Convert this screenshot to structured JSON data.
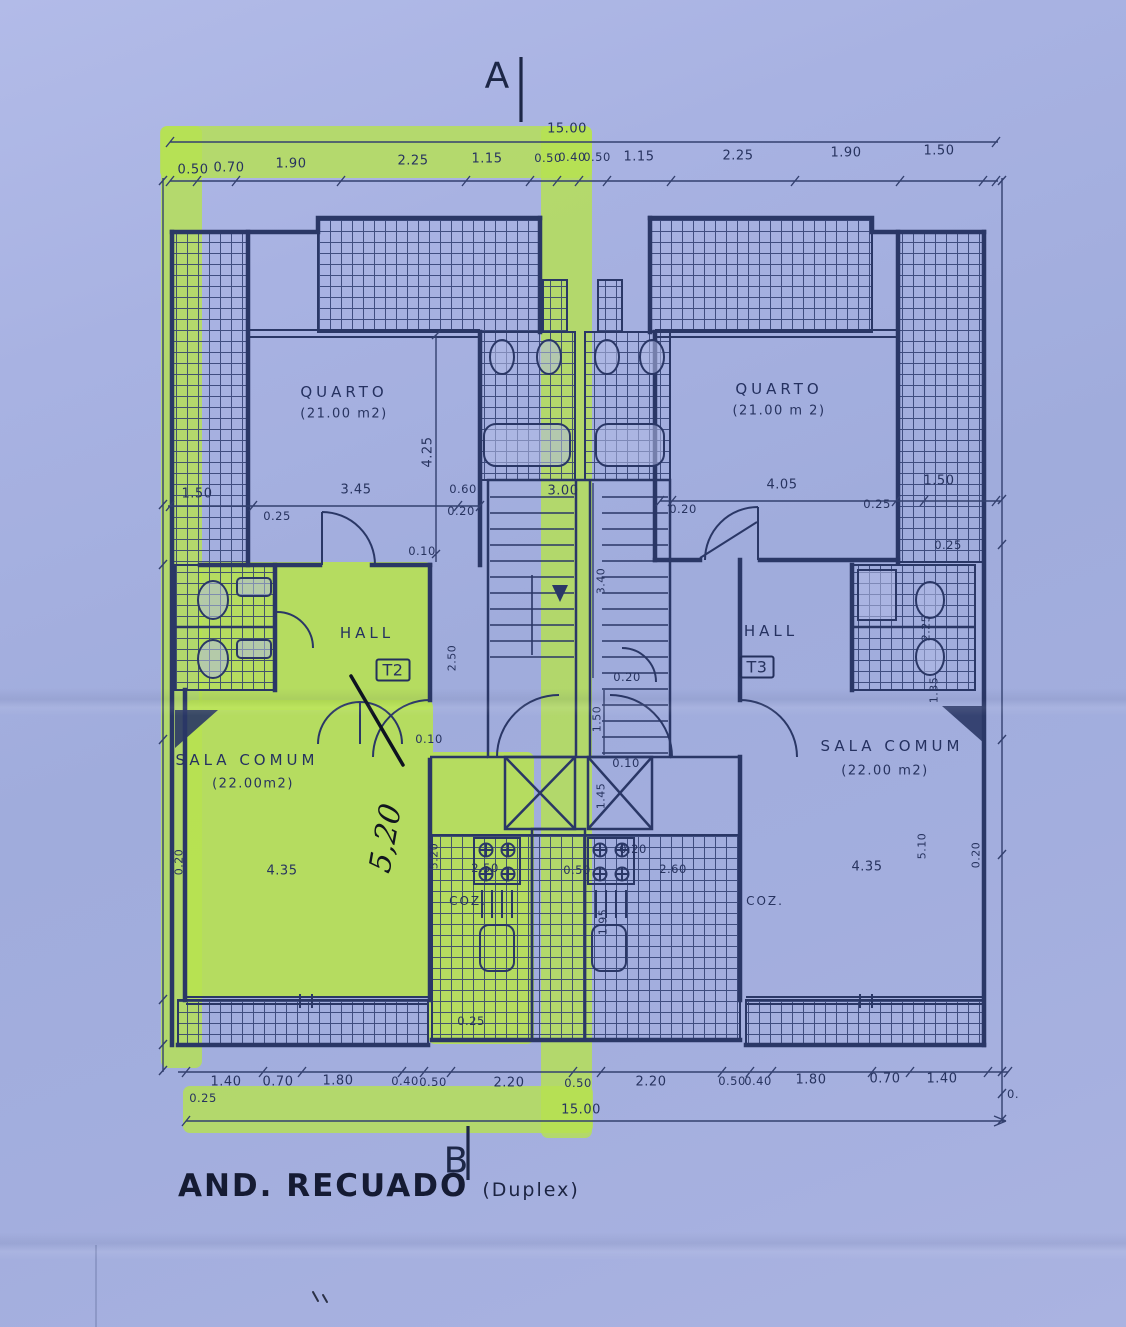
{
  "page": {
    "paper_color": "#a6b1e0",
    "ink_color": "#2a3766",
    "highlight_color": "#b7e24f"
  },
  "title": {
    "main": "AND. RECUADO",
    "sub": "(Duplex)"
  },
  "section_markers": {
    "top": "A",
    "bottom": "B"
  },
  "plan": {
    "overall_width_top": "15.00",
    "overall_width_bottom": "15.00",
    "units": [
      "T2",
      "T3"
    ],
    "rooms": [
      {
        "name": "QUARTO",
        "area": "(21.00 m2)",
        "unit": "T2"
      },
      {
        "name": "QUARTO",
        "area": "(21.00 m 2)",
        "unit": "T3"
      },
      {
        "name": "HALL",
        "unit": "T2"
      },
      {
        "name": "HALL",
        "unit": "T3"
      },
      {
        "name": "SALA COMUM",
        "area": "(22.00m2)",
        "unit": "T2"
      },
      {
        "name": "SALA COMUM",
        "area": "(22.00 m2)",
        "unit": "T3"
      },
      {
        "name": "COZ.",
        "unit": "T2"
      },
      {
        "name": "COZ.",
        "unit": "T3"
      }
    ]
  },
  "labels": [
    {
      "n": "dim-label",
      "t": "15.00",
      "x": 567,
      "y": 129,
      "c": "d"
    },
    {
      "n": "dim-label",
      "t": "0.50",
      "x": 193,
      "y": 170,
      "c": "d"
    },
    {
      "n": "dim-label",
      "t": "0.70",
      "x": 229,
      "y": 168,
      "c": "d"
    },
    {
      "n": "dim-label",
      "t": "1.90",
      "x": 291,
      "y": 164,
      "c": "d"
    },
    {
      "n": "dim-label",
      "t": "2.25",
      "x": 413,
      "y": 161,
      "c": "d"
    },
    {
      "n": "dim-label",
      "t": "1.15",
      "x": 487,
      "y": 159,
      "c": "d"
    },
    {
      "n": "dim-label",
      "t": "0.50",
      "x": 548,
      "y": 158,
      "c": "ds"
    },
    {
      "n": "dim-label",
      "t": "0.40",
      "x": 572,
      "y": 157,
      "c": "ds"
    },
    {
      "n": "dim-label",
      "t": "0.50",
      "x": 597,
      "y": 157,
      "c": "ds"
    },
    {
      "n": "dim-label",
      "t": "1.15",
      "x": 639,
      "y": 157,
      "c": "d"
    },
    {
      "n": "dim-label",
      "t": "2.25",
      "x": 738,
      "y": 156,
      "c": "d"
    },
    {
      "n": "dim-label",
      "t": "1.90",
      "x": 846,
      "y": 153,
      "c": "d"
    },
    {
      "n": "dim-label",
      "t": "1.50",
      "x": 939,
      "y": 151,
      "c": "d"
    },
    {
      "n": "room-label",
      "t": "QUARTO",
      "x": 344,
      "y": 392,
      "c": "room"
    },
    {
      "n": "area-label",
      "t": "(21.00 m2)",
      "x": 344,
      "y": 414,
      "c": "area"
    },
    {
      "n": "room-label",
      "t": "QUARTO",
      "x": 779,
      "y": 389,
      "c": "room"
    },
    {
      "n": "area-label",
      "t": "(21.00 m 2)",
      "x": 779,
      "y": 411,
      "c": "area"
    },
    {
      "n": "dim-label",
      "t": "4.25",
      "x": 428,
      "y": 452,
      "c": "dv"
    },
    {
      "n": "dim-label",
      "t": "1.50",
      "x": 197,
      "y": 494,
      "c": "d"
    },
    {
      "n": "dim-label",
      "t": "3.45",
      "x": 356,
      "y": 490,
      "c": "d"
    },
    {
      "n": "dim-label",
      "t": "0.25",
      "x": 277,
      "y": 516,
      "c": "ds"
    },
    {
      "n": "dim-label",
      "t": "0.60",
      "x": 463,
      "y": 489,
      "c": "ds"
    },
    {
      "n": "dim-label",
      "t": "0.20",
      "x": 461,
      "y": 511,
      "c": "ds"
    },
    {
      "n": "dim-label",
      "t": "3.00",
      "x": 563,
      "y": 491,
      "c": "d"
    },
    {
      "n": "dim-label",
      "t": "0.20",
      "x": 683,
      "y": 509,
      "c": "ds"
    },
    {
      "n": "dim-label",
      "t": "4.05",
      "x": 782,
      "y": 485,
      "c": "d"
    },
    {
      "n": "dim-label",
      "t": "0.25",
      "x": 877,
      "y": 504,
      "c": "ds"
    },
    {
      "n": "dim-label",
      "t": "1.50",
      "x": 939,
      "y": 481,
      "c": "d"
    },
    {
      "n": "dim-label",
      "t": "0.25",
      "x": 948,
      "y": 545,
      "c": "ds"
    },
    {
      "n": "dim-label",
      "t": "0.10",
      "x": 422,
      "y": 551,
      "c": "ds"
    },
    {
      "n": "dim-label",
      "t": "3.40",
      "x": 601,
      "y": 581,
      "c": "dsv"
    },
    {
      "n": "room-label",
      "t": "HALL",
      "x": 367,
      "y": 633,
      "c": "room"
    },
    {
      "n": "unit-badge",
      "t": "T2",
      "x": 393,
      "y": 670,
      "c": "unit"
    },
    {
      "n": "room-label",
      "t": "HALL",
      "x": 771,
      "y": 631,
      "c": "room"
    },
    {
      "n": "unit-badge",
      "t": "T3",
      "x": 757,
      "y": 667,
      "c": "unit"
    },
    {
      "n": "dim-label",
      "t": "2.50",
      "x": 452,
      "y": 658,
      "c": "dsv"
    },
    {
      "n": "dim-label",
      "t": "2.25",
      "x": 926,
      "y": 628,
      "c": "dsv"
    },
    {
      "n": "dim-label",
      "t": "1.35",
      "x": 934,
      "y": 690,
      "c": "dsv"
    },
    {
      "n": "dim-label",
      "t": "0.20",
      "x": 627,
      "y": 677,
      "c": "ds"
    },
    {
      "n": "dim-label",
      "t": "1.50",
      "x": 597,
      "y": 719,
      "c": "dsv"
    },
    {
      "n": "dim-label",
      "t": "0.10",
      "x": 429,
      "y": 739,
      "c": "ds"
    },
    {
      "n": "room-label",
      "t": "SALA COMUM",
      "x": 247,
      "y": 760,
      "c": "room"
    },
    {
      "n": "area-label",
      "t": "(22.00m2)",
      "x": 253,
      "y": 784,
      "c": "area"
    },
    {
      "n": "dim-label",
      "t": "0.10",
      "x": 626,
      "y": 763,
      "c": "ds"
    },
    {
      "n": "dim-label",
      "t": "1.45",
      "x": 601,
      "y": 796,
      "c": "dsv"
    },
    {
      "n": "room-label",
      "t": "SALA COMUM",
      "x": 892,
      "y": 746,
      "c": "room"
    },
    {
      "n": "area-label",
      "t": "(22.00 m2)",
      "x": 885,
      "y": 771,
      "c": "area"
    },
    {
      "n": "handwritten-dim",
      "t": "5,20",
      "x": 386,
      "y": 838,
      "c": "hand"
    },
    {
      "n": "dim-label",
      "t": "5.20",
      "x": 434,
      "y": 856,
      "c": "dsv"
    },
    {
      "n": "dim-label",
      "t": "0.20",
      "x": 179,
      "y": 862,
      "c": "dsv"
    },
    {
      "n": "dim-label",
      "t": "4.35",
      "x": 282,
      "y": 871,
      "c": "d"
    },
    {
      "n": "dim-label",
      "t": "2.50",
      "x": 485,
      "y": 868,
      "c": "ds"
    },
    {
      "n": "dim-label",
      "t": "0.50",
      "x": 577,
      "y": 870,
      "c": "ds"
    },
    {
      "n": "dim-label",
      "t": "0.20",
      "x": 633,
      "y": 849,
      "c": "ds"
    },
    {
      "n": "dim-label",
      "t": "2.60",
      "x": 673,
      "y": 869,
      "c": "ds"
    },
    {
      "n": "room-label",
      "t": "COZ.",
      "x": 468,
      "y": 901,
      "c": "coz"
    },
    {
      "n": "room-label",
      "t": "COZ.",
      "x": 765,
      "y": 901,
      "c": "coz"
    },
    {
      "n": "dim-label",
      "t": "4.35",
      "x": 867,
      "y": 867,
      "c": "d"
    },
    {
      "n": "dim-label",
      "t": "5.10",
      "x": 922,
      "y": 846,
      "c": "dsv"
    },
    {
      "n": "dim-label",
      "t": "0.20",
      "x": 976,
      "y": 855,
      "c": "dsv"
    },
    {
      "n": "dim-label",
      "t": "1.95",
      "x": 603,
      "y": 922,
      "c": "dsv"
    },
    {
      "n": "dim-label",
      "t": "0.25",
      "x": 471,
      "y": 1021,
      "c": "ds"
    },
    {
      "n": "dim-label",
      "t": "1.40",
      "x": 226,
      "y": 1082,
      "c": "d"
    },
    {
      "n": "dim-label",
      "t": "0.70",
      "x": 278,
      "y": 1082,
      "c": "d"
    },
    {
      "n": "dim-label",
      "t": "1.80",
      "x": 338,
      "y": 1081,
      "c": "d"
    },
    {
      "n": "dim-label",
      "t": "0.40",
      "x": 405,
      "y": 1081,
      "c": "ds"
    },
    {
      "n": "dim-label",
      "t": "0.50",
      "x": 433,
      "y": 1082,
      "c": "ds"
    },
    {
      "n": "dim-label",
      "t": "2.20",
      "x": 509,
      "y": 1083,
      "c": "d"
    },
    {
      "n": "dim-label",
      "t": "0.50",
      "x": 578,
      "y": 1083,
      "c": "ds"
    },
    {
      "n": "dim-label",
      "t": "2.20",
      "x": 651,
      "y": 1082,
      "c": "d"
    },
    {
      "n": "dim-label",
      "t": "0.50",
      "x": 732,
      "y": 1081,
      "c": "ds"
    },
    {
      "n": "dim-label",
      "t": "0.40",
      "x": 758,
      "y": 1081,
      "c": "ds"
    },
    {
      "n": "dim-label",
      "t": "1.80",
      "x": 811,
      "y": 1080,
      "c": "d"
    },
    {
      "n": "dim-label",
      "t": "0.70",
      "x": 885,
      "y": 1079,
      "c": "d"
    },
    {
      "n": "dim-label",
      "t": "1.40",
      "x": 942,
      "y": 1079,
      "c": "d"
    },
    {
      "n": "dim-label",
      "t": "0.25",
      "x": 203,
      "y": 1098,
      "c": "ds"
    },
    {
      "n": "dim-label",
      "t": "0.",
      "x": 1013,
      "y": 1094,
      "c": "ds"
    },
    {
      "n": "dim-label",
      "t": "15.00",
      "x": 581,
      "y": 1110,
      "c": "d"
    }
  ]
}
